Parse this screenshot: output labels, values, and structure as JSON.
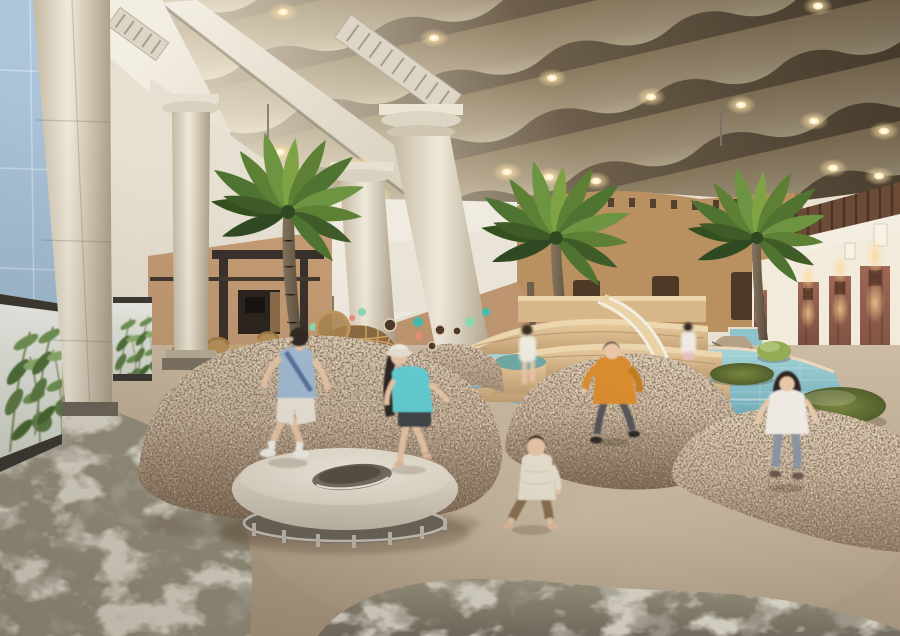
{
  "meta": {
    "kind": "architectural-interior-rendering",
    "subject": "Indoor children's sand-play area with wavy acoustic ceiling, classical colonnade, palm trees, pebble mounds, round bouncer, pool deck with slide and a door-lined corridor"
  },
  "palette": {
    "wall_blue": "#a9c2d8",
    "wall_white": "#efebe0",
    "wall_tan": "#c39b74",
    "fort_tan": "#b9905f",
    "corridor_cream": "#f2ebdc",
    "ceiling_dark": "#6e5e46",
    "ceiling_light": "#d8cdb0",
    "beam_white": "#eee9dc",
    "column_cream": "#e3dbc8",
    "water": "#8fc3cc",
    "wood": "#d7b78a",
    "teal_platform": "#6fa8a2",
    "speckle_base": "#c8b29a",
    "carpet": "#97917e",
    "sand": "#c2b096",
    "pouf_green": "#93ac52",
    "pouf_olive": "#66743a",
    "pilaster_brown": "#8a564a",
    "pergola": "#38302a",
    "dome_rattan": "#cfa362",
    "palm_green": "#5d8034",
    "trunk": "#75654f",
    "disc_cream": "#e9e3d5",
    "glow": "#ffe2a8",
    "dot_mint": "#8ed8b4",
    "dot_teal": "#41bcae",
    "dot_coral": "#e89078",
    "porthole": "#4e3a2a",
    "leaf_green": "#6f9454",
    "panel_bg": "#e6e9de",
    "skin": "#e9c6a8"
  },
  "scene": {
    "ceiling": {
      "style": "wave-baffle rows with recessed warm downlights",
      "lamp_count": 18
    },
    "left": "blue glazed facade behind cream classical colonnade with botanical-print glass balustrade",
    "center": "white and tan walls with porthole dots, rattan dome, speckled pebble mounds and round bouncer disc",
    "right": "cream corridor with stone pilasters, twin-glow sconces and pebble-shaped poufs",
    "background": "tan fort-style pool house, wooden tiered deck with slide, indoor pool and palm trees"
  },
  "figures": [
    {
      "name": "jumping-boy",
      "top": "#a3bdd4",
      "bottom": "#ece7da"
    },
    {
      "name": "hat-girl",
      "top": "#62cfd4",
      "bottom": "#3f4448",
      "hat": "#f1ede3"
    },
    {
      "name": "walking-toddler",
      "top": "#eae2d0",
      "bottom": "#8a6f52"
    },
    {
      "name": "running-boy",
      "top": "#d98c2e",
      "bottom": "#56565a"
    },
    {
      "name": "running-girl",
      "top": "#eee9e2",
      "bottom": "#8a93a0"
    },
    {
      "name": "deck-girl",
      "top": "#efeae0"
    },
    {
      "name": "poolside-girl",
      "top": "#f0e8e2"
    },
    {
      "name": "cafe-guest",
      "top": "#d8d4c8"
    }
  ]
}
